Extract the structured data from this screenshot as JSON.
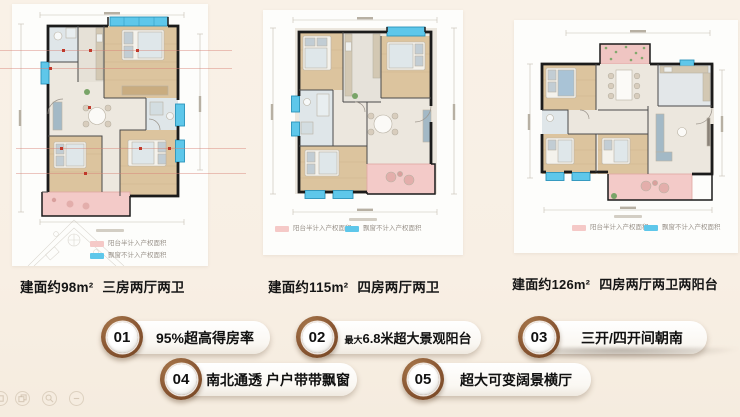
{
  "page": {
    "background": "#f8efe4",
    "accent_brown": "#8a5733",
    "balcony_pink": "#f5c9c7",
    "bay_blue": "#5ec7ea"
  },
  "units": [
    {
      "area": "建面约98m²",
      "layout": "三房两厅两卫",
      "legend_balcony": "阳台半计入产权面积",
      "legend_bay": "飘窗不计入产权面积"
    },
    {
      "area": "建面约115m²",
      "layout": "四房两厅两卫",
      "legend_balcony": "阳台半计入产权面积",
      "legend_bay": "飘窗不计入产权面积"
    },
    {
      "area": "建面约126m²",
      "layout": "四房两厅两卫两阳台",
      "legend_balcony": "阳台半计入产权面积",
      "legend_bay": "飘窗不计入产权面积"
    }
  ],
  "features": [
    {
      "number": "01",
      "prefix": "",
      "text": "95%超高得房率"
    },
    {
      "number": "02",
      "prefix": "最大",
      "text": "6.8米超大景观阳台"
    },
    {
      "number": "03",
      "prefix": "",
      "text": "三开/四开间朝南"
    },
    {
      "number": "04",
      "prefix": "",
      "text": "南北通透 户户带带飘窗"
    },
    {
      "number": "05",
      "prefix": "",
      "text": "超大可变阔景横厅"
    }
  ]
}
